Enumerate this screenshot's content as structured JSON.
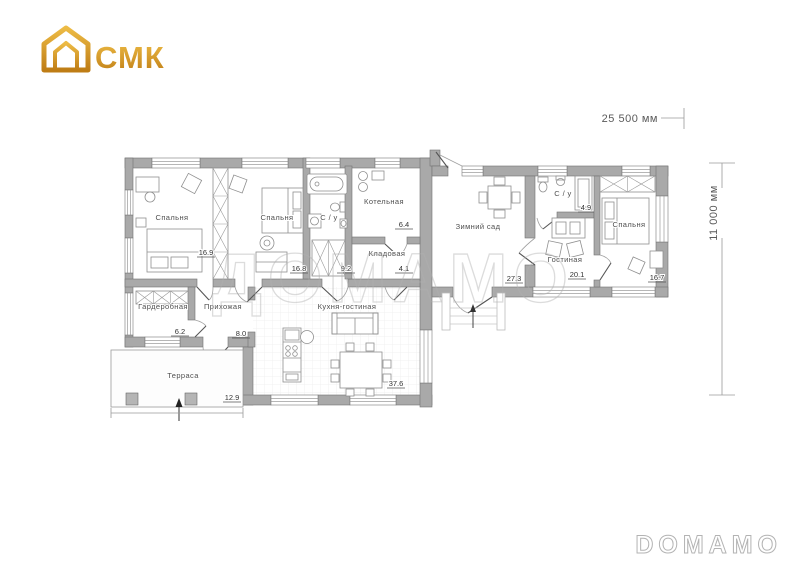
{
  "logo": {
    "text": "СМК"
  },
  "watermarks": {
    "center": "ДОМАМО",
    "corner": "DOMAMO"
  },
  "dimensions": {
    "width": "25 500 мм",
    "height": "11 000 мм"
  },
  "colors": {
    "wall": "#a9a9a9",
    "logo_gold": "#d99a28",
    "watermark_outline": "#cccccc"
  },
  "rooms": [
    {
      "label": "Спальня",
      "area": "16.9"
    },
    {
      "label": "Спальня",
      "area": "16.8"
    },
    {
      "label": "С / у",
      "area": "9.2"
    },
    {
      "label": "Котельная",
      "area": "6.4"
    },
    {
      "label": "Кладовая",
      "area": "4.1"
    },
    {
      "label": "Гардеробная",
      "area": "6.2"
    },
    {
      "label": "Прихожая",
      "area": "8.0"
    },
    {
      "label": "Кухня-гостиная",
      "area": "37.6"
    },
    {
      "label": "Терраса",
      "area": "12.9"
    },
    {
      "label": "Зимний сад",
      "area": "27.3"
    },
    {
      "label": "С / у",
      "area": "4.9"
    },
    {
      "label": "Гостиная",
      "area": "20.1"
    },
    {
      "label": "Спальня",
      "area": "16.7"
    }
  ]
}
